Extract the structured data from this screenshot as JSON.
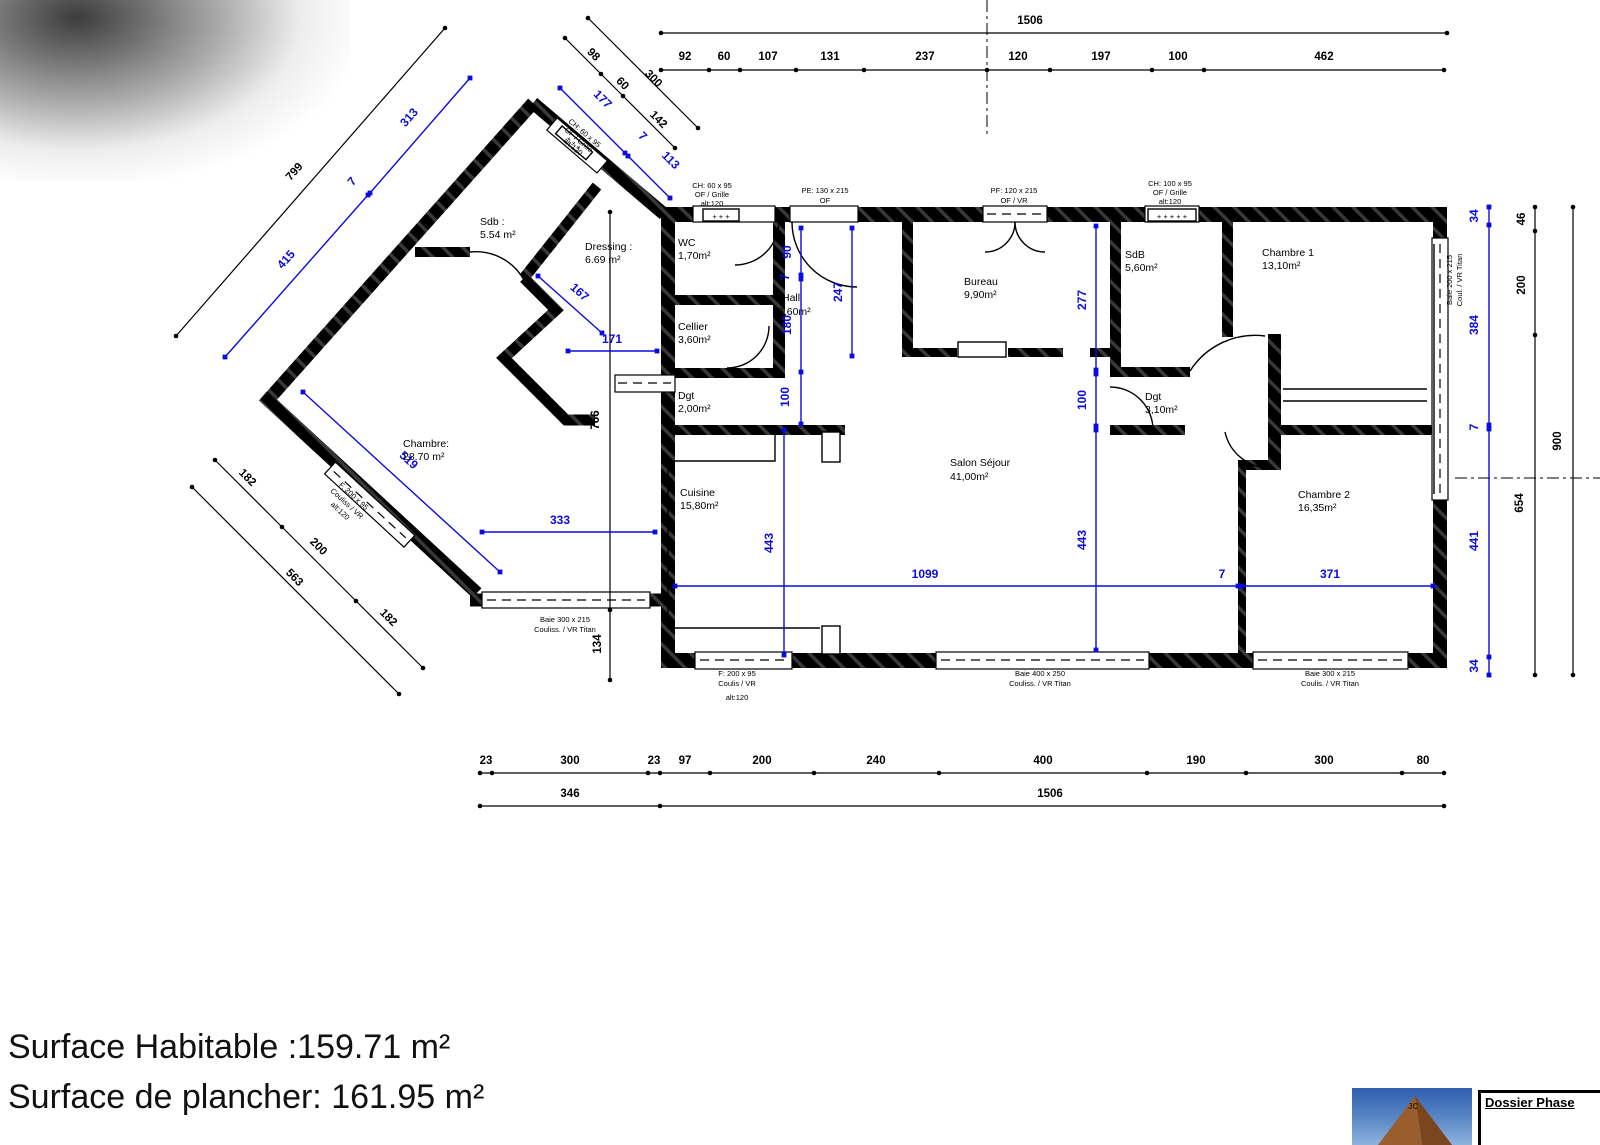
{
  "colors": {
    "dim_blue": "#0b0bdf",
    "wall": "#000000"
  },
  "summary": {
    "line1": "Surface Habitable  :159.71 m²",
    "line2": "Surface de plancher: 161.95 m²"
  },
  "title_block": {
    "label": "Dossier Phase"
  },
  "photo": {
    "overlay_text": "JC"
  },
  "rooms": {
    "sdb_wing": {
      "name": "Sdb :",
      "area": "5.54 m²"
    },
    "dressing": {
      "name": "Dressing :",
      "area": "6.69 m²"
    },
    "chambre_wing": {
      "name": "Chambre:",
      "area": "28.70 m²"
    },
    "wc": {
      "name": "WC",
      "area": "1,70m²"
    },
    "cellier": {
      "name": "Cellier",
      "area": "3,60m²"
    },
    "hall": {
      "name": "Hall",
      "area": "6,60m²"
    },
    "dgt1": {
      "name": "Dgt",
      "area": "2,00m²"
    },
    "cuisine": {
      "name": "Cuisine",
      "area": "15,80m²"
    },
    "bureau": {
      "name": "Bureau",
      "area": "9,90m²"
    },
    "salon": {
      "name": "Salon Séjour",
      "area": "41,00m²"
    },
    "sdb": {
      "name": "SdB",
      "area": "5,60m²"
    },
    "chambre1": {
      "name": "Chambre 1",
      "area": "13,10m²"
    },
    "dgt2": {
      "name": "Dgt",
      "area": "3,10m²"
    },
    "chambre2": {
      "name": "Chambre 2",
      "area": "16,35m²"
    }
  },
  "openings": {
    "wing_ch60": {
      "l1": "CH: 60 x 95",
      "l2": "OF / Grille",
      "l3": "alt:120"
    },
    "wc_ch60": {
      "l1": "CH: 60 x 95",
      "l2": "OF / Grille",
      "l3": "alt:120"
    },
    "pe": {
      "l1": "PE: 130 x 215",
      "l2": "OF"
    },
    "pf": {
      "l1": "PF: 120 x 215",
      "l2": "OF / VR"
    },
    "ch100": {
      "l1": "CH: 100 x 95",
      "l2": "OF / Grille",
      "l3": "alt:120"
    },
    "baie200": {
      "l1": "Baie 200 x 215",
      "l2": "Coul. / VR Titan"
    },
    "f200": {
      "l1": "F: 200 x 95",
      "l2": "Coulis / VR",
      "l3": "alt:120"
    },
    "baie400": {
      "l1": "Baie 400 x 250",
      "l2": "Couliss. / VR Titan"
    },
    "baie300": {
      "l1": "Baie 300 x 215",
      "l2": "Coulis. / VR Titan"
    },
    "wing_baie300": {
      "l1": "Baie 300 x 215",
      "l2": "Couliss. / VR Titan"
    },
    "wing_f200": {
      "l1": "F. 200 x 95",
      "l2": "Couliss / VR",
      "l3": "alt:120"
    },
    "plus3": "+ + +",
    "plus5": "+ + + + +"
  },
  "dims": {
    "top_total": "1506",
    "top_seg": [
      "92",
      "60",
      "107",
      "131",
      "237",
      "120",
      "197",
      "100",
      "462"
    ],
    "diag_total": "799",
    "diag_blue": [
      "415",
      "7",
      "313"
    ],
    "apex_seg": [
      "98",
      "60",
      "142"
    ],
    "apex_total": "300",
    "apex_blue": [
      "177",
      "7",
      "113"
    ],
    "wing": {
      "d519": "519",
      "d167": "167",
      "d171": "171",
      "d333": "333"
    },
    "left_vert": [
      "766",
      "134"
    ],
    "lower_seg": [
      "182",
      "200",
      "182"
    ],
    "lower_total": "563",
    "hall": [
      "90",
      "7",
      "180",
      "100"
    ],
    "hall_depth": "247",
    "mid_vert": [
      "277",
      "100",
      "443"
    ],
    "kitchen": "443",
    "inner_bottom": [
      "1099",
      "7",
      "371"
    ],
    "right_blue": [
      "34",
      "384",
      "7",
      "441",
      "34"
    ],
    "right_black": [
      "46",
      "200",
      "654"
    ],
    "right_total": "900",
    "bottom1": [
      "23",
      "300",
      "23",
      "97",
      "200",
      "240",
      "400",
      "190",
      "300",
      "80"
    ],
    "bottom2": [
      "346",
      "1506"
    ]
  }
}
